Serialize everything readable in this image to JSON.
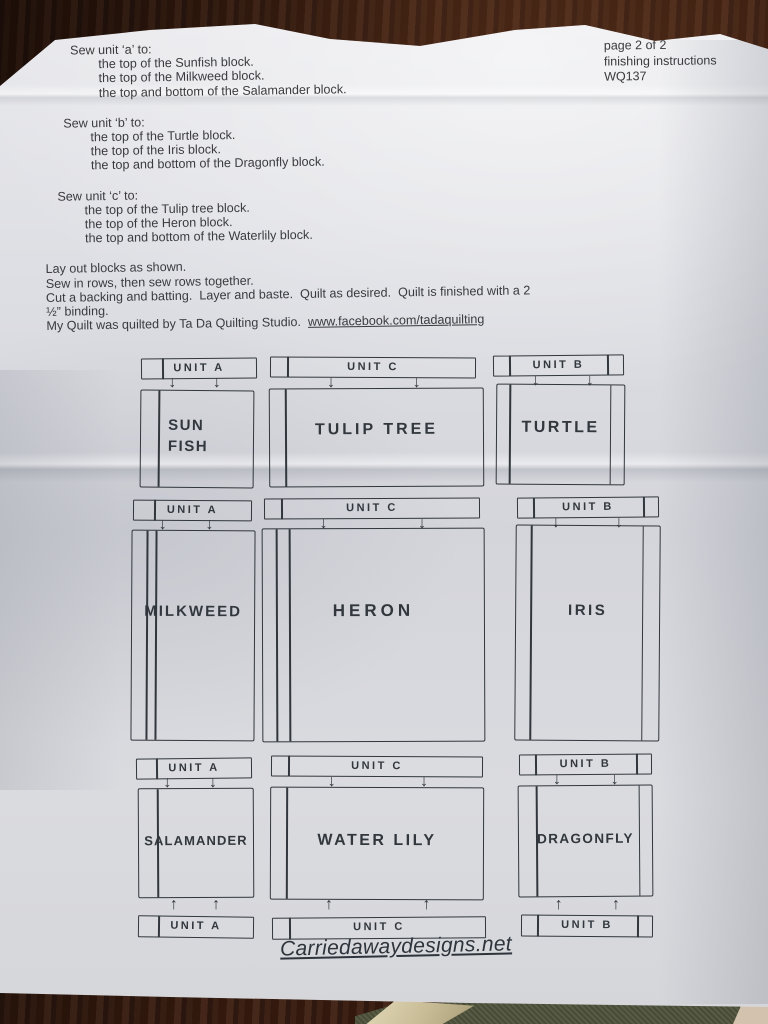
{
  "header": {
    "page_number": "page 2 of 2",
    "doc_type": "finishing instructions",
    "pattern_code": "WQ137"
  },
  "sew_sections": [
    {
      "heading": "Sew unit ‘a’ to:",
      "items": [
        "the top of the Sunfish block.",
        "the top of the Milkweed block.",
        "the top and bottom of the Salamander block."
      ]
    },
    {
      "heading": "Sew unit ‘b’ to:",
      "items": [
        "the top of the Turtle block.",
        "the top of the Iris block.",
        "the top and bottom of the Dragonfly block."
      ]
    },
    {
      "heading": "Sew unit ‘c’ to:",
      "items": [
        "the top of the Tulip tree block.",
        "the top of the Heron block.",
        "the top and bottom of the Waterlily block."
      ]
    }
  ],
  "assembly_lines": [
    "Lay out blocks as shown.",
    "Sew in rows, then sew rows together.",
    "Cut a backing and batting.  Layer and baste.  Quilt as desired.  Quilt is finished with a 2",
    "½” binding."
  ],
  "credit": {
    "text": "My Quilt was quilted by Ta Da Quilting Studio.  ",
    "link": "www.facebook.com/tadaquilting"
  },
  "diagram": {
    "unit_labels": [
      "UNIT A",
      "UNIT C",
      "UNIT B"
    ],
    "block_rows": [
      [
        "SUN\nFISH",
        "TULIP TREE",
        "TURTLE"
      ],
      [
        "MILKWEED",
        "HERON",
        "IRIS"
      ],
      [
        "SALAMANDER",
        "WATER LILY",
        "DRAGONFLY"
      ]
    ],
    "arrow_down": "↓",
    "arrow_up": "↑"
  },
  "footer": {
    "website": "Carriedawaydesigns.net"
  },
  "colors": {
    "paper": "#dadbe0",
    "ink": "#31373d",
    "print": "#3a3a3f",
    "wood": "#38200f",
    "green": "#4e523a",
    "tan": "#c9bd98"
  }
}
